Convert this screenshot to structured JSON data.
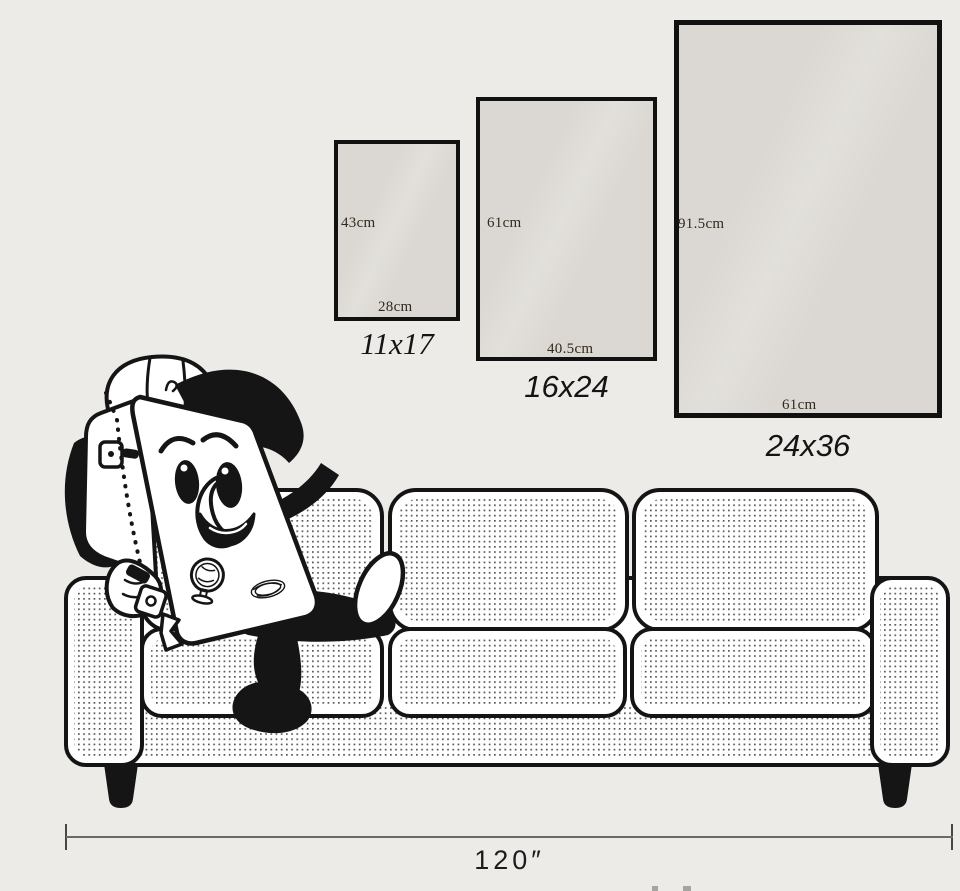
{
  "page": {
    "background": "#ecebe8"
  },
  "posters": [
    {
      "id": "11x17",
      "size_label": "11x17",
      "height_label": "43cm",
      "width_label": "28cm"
    },
    {
      "id": "16x24",
      "size_label": "16x24",
      "height_label": "61cm",
      "width_label": "40.5cm"
    },
    {
      "id": "24x36",
      "size_label": "24x36",
      "height_label": "91.5cm",
      "width_label": "61cm"
    }
  ],
  "sofa": {
    "width_label": "120″"
  },
  "illustration": {
    "character": "travel-suitcase-mascot",
    "furniture": "three-seat-sofa"
  },
  "colors": {
    "background": "#ecebe8",
    "poster_fill": "#dbd8d3",
    "outline": "#141414",
    "dimension_line": "#6a6a6a",
    "label_text": "#33291c"
  }
}
